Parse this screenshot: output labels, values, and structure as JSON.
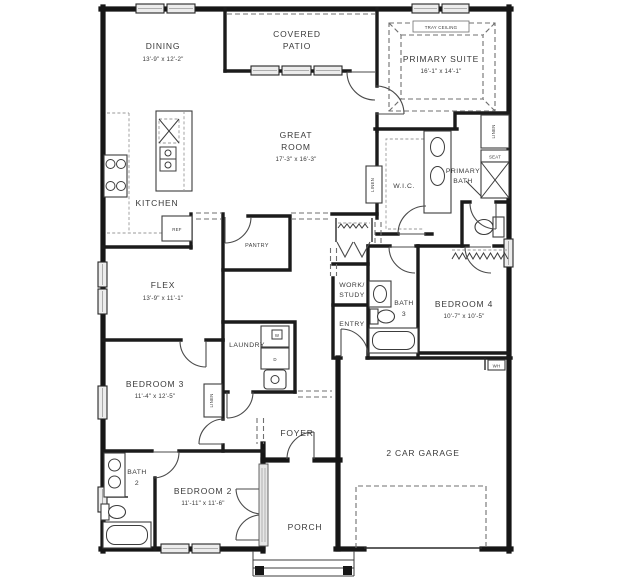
{
  "plan": {
    "type": "single-story residential floor plan",
    "rooms": {
      "dining": {
        "name": "DINING",
        "dims": "13'-9\" x 12'-2\""
      },
      "covered_patio": {
        "line1": "COVERED",
        "line2": "PATIO"
      },
      "primary_suite": {
        "name": "PRIMARY SUITE",
        "dims": "16'-1\" x 14'-1\""
      },
      "great_room": {
        "line1": "GREAT",
        "line2": "ROOM",
        "dims": "17'-3\" x 16'-3\""
      },
      "kitchen": {
        "name": "KITCHEN"
      },
      "wic": {
        "name": "W.I.C."
      },
      "primary_bath": {
        "line1": "PRIMARY",
        "line2": "BATH"
      },
      "pantry": {
        "name": "PANTRY"
      },
      "flex": {
        "name": "FLEX",
        "dims": "13'-9\" x 11'-1\""
      },
      "work_study": {
        "line1": "WORK/",
        "line2": "STUDY"
      },
      "bath3": {
        "line1": "BATH",
        "line2": "3"
      },
      "bedroom4": {
        "name": "BEDROOM 4",
        "dims": "10'-7\" x 10'-5\""
      },
      "entry": {
        "name": "ENTRY"
      },
      "laundry": {
        "name": "LAUNDRY"
      },
      "bedroom3": {
        "name": "BEDROOM 3",
        "dims": "11'-4\" x 12'-5\""
      },
      "foyer": {
        "name": "FOYER"
      },
      "garage": {
        "name": "2 CAR GARAGE"
      },
      "bath2": {
        "line1": "BATH",
        "line2": "2"
      },
      "bedroom2": {
        "name": "BEDROOM 2",
        "dims": "11'-11\" x 11'-6\""
      },
      "porch": {
        "name": "PORCH"
      }
    },
    "labels": {
      "tray_ceiling": "TRAY CEILING",
      "ref": "REF",
      "seat": "SEAT",
      "wh": "WH",
      "washer": "W",
      "dryer": "D",
      "linen": "LINEN"
    },
    "colors": {
      "wall": "#161616",
      "text": "#3a3a3a",
      "window_fill": "#ececec",
      "dashed_line": "#6f6f6f",
      "background": "#ffffff"
    }
  }
}
